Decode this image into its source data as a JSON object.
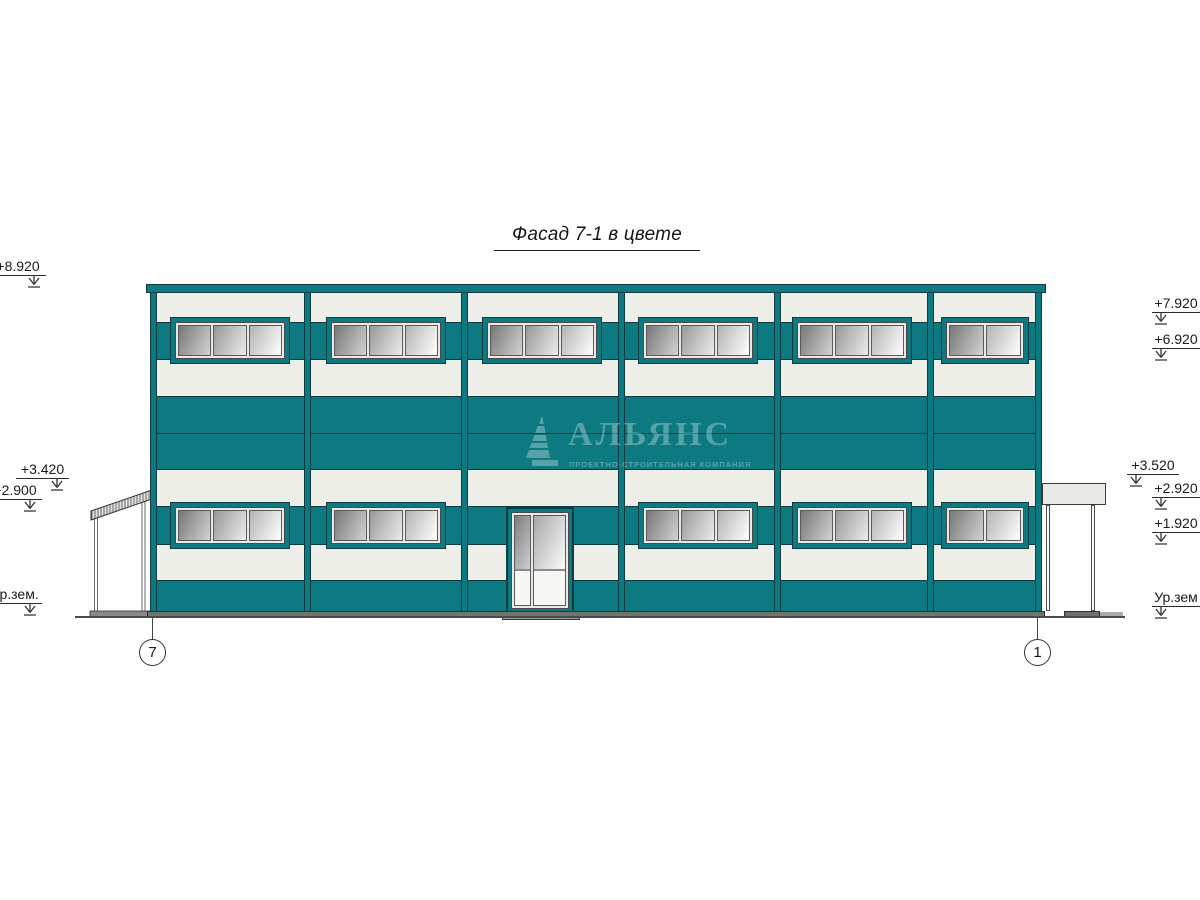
{
  "title": "Фасад 7-1 в цвете",
  "watermark": {
    "name": "АЛЬЯНС",
    "tagline": "ПРОЕКТНО-СТРОИТЕЛЬНАЯ КОМПАНИЯ"
  },
  "elevation_marks": {
    "left": [
      {
        "label": "+8.920"
      },
      {
        "label": "+3.420"
      },
      {
        "label": "+2.900"
      },
      {
        "label": "Ур.зем."
      }
    ],
    "right": [
      {
        "label": "+7.920"
      },
      {
        "label": "+6.920"
      },
      {
        "label": "+3.520"
      },
      {
        "label": "+2.920"
      },
      {
        "label": "+1.920"
      },
      {
        "label": "Ур.зем"
      }
    ]
  },
  "axis_markers": [
    {
      "label": "7"
    },
    {
      "label": "1"
    }
  ],
  "colors": {
    "facade_teal": "#0d7a82",
    "facade_outline": "#12393d",
    "panel_light": "#edeee8",
    "ink": "#1a1a1a"
  }
}
